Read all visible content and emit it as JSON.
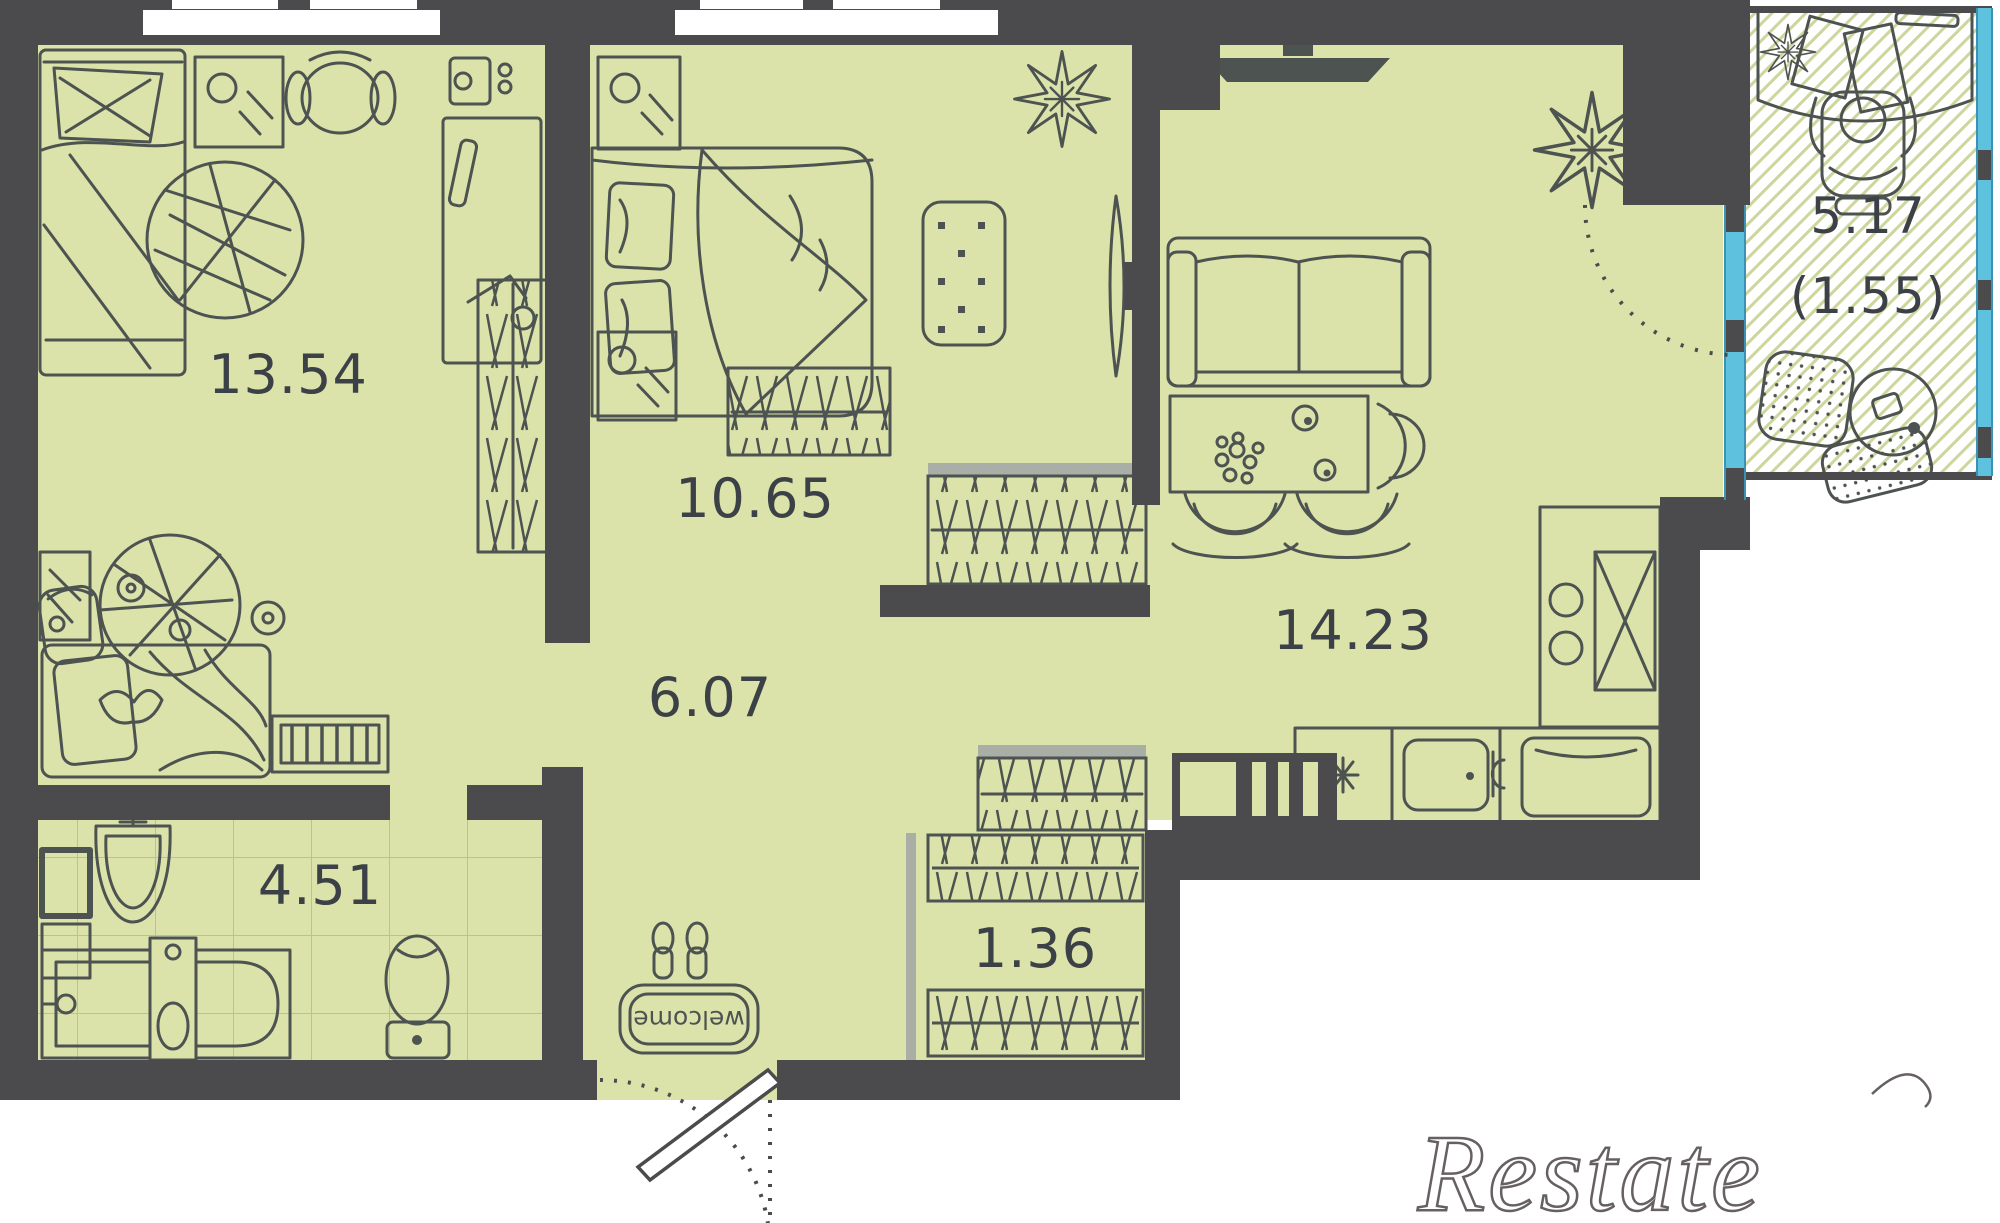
{
  "title": "Apartment floor plan",
  "plan": {
    "rooms": [
      {
        "key": "bedroom-1",
        "area": "13.54"
      },
      {
        "key": "bedroom-2",
        "area": "10.65"
      },
      {
        "key": "hallway",
        "area": "6.07"
      },
      {
        "key": "bathroom",
        "area": "4.51"
      },
      {
        "key": "closet",
        "area": "1.36"
      },
      {
        "key": "kitchen-living",
        "area": "14.23"
      },
      {
        "key": "balcony",
        "area": "5.17",
        "area_weighted": "(1.55)"
      }
    ],
    "entrance_mat_text": "welcome"
  },
  "watermark": {
    "text": "Restate"
  },
  "colors": {
    "floor": "#dbe3ab",
    "wall": "#4b4b4d",
    "window_glass": "#5ec1dd",
    "balcony_hatch": "#ccd69d",
    "furniture_stroke": "#4d5350",
    "tile_line": "#b9c48c",
    "label_text": "#3b4146",
    "watermark_stroke": "#676062"
  }
}
